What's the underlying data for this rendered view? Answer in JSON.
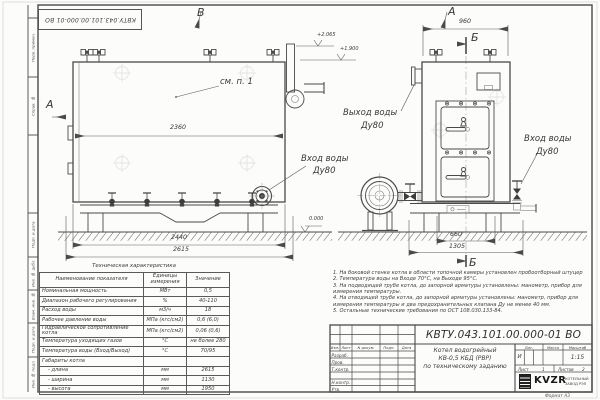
{
  "stamp": "КВТУ.043.101.00.000-01 ВО",
  "margin_labels": [
    "Перв. примен.",
    "Справ. №",
    "Подп. и дата",
    "Инв. № дубл.",
    "Взам. инв. №",
    "Подп. и дата",
    "Инв. № подл."
  ],
  "labels": {
    "view_b": "В",
    "section_a": "А",
    "view_a": "А",
    "section_b": "Б",
    "see_note": "см. п. 1",
    "outlet1": "Выход воды",
    "outlet2": "Ду80",
    "inlet1": "Вход воды",
    "inlet2": "Ду80"
  },
  "dims": {
    "body_len": "2360",
    "base_len": "2440",
    "total_len": "2615",
    "front_w": "960",
    "base_w": "660",
    "total_w": "1305",
    "lvl_zero": "0.000",
    "lvl_top": "+2.065",
    "lvl_mid": "+1.900"
  },
  "notes": [
    "1. На боковой стенке котла в области топочной камеры установлен пробоотборный штуцер",
    "2. Температура воды на Входе 70°С, на Выходе 95°С.",
    "3. На подводящей трубе котла, до запорной арматуры установлены: манометр, прибор для измерения температуры.",
    "4. На отводящей трубе котла, до запорной арматуры установлены: манометр, прибор для измерения температуры и два предохранительных клапана Ду не менее 40 мм.",
    "5. Остальные технические требования по ОСТ 108.030.133-84."
  ],
  "table": {
    "title": "Техническая характеристика",
    "headers": [
      "Наименование показателя",
      "Единицы измерения",
      "Значение"
    ],
    "rows": [
      {
        "name": "Номинальная мощность",
        "unit": "МВт",
        "value": "0,5"
      },
      {
        "name": "Диапазон рабочего регулирования",
        "unit": "%",
        "value": "40-110"
      },
      {
        "name": "Расход воды",
        "unit": "м3/ч",
        "value": "18"
      },
      {
        "name": "Рабочее давление воды",
        "unit": "МПа (кгс/см2)",
        "value": "0,6 (6,0)"
      },
      {
        "name": "Гидравлическое сопротивление котла",
        "unit": "МПа (кгс/см2)",
        "value": "0,06 (0,6)"
      },
      {
        "name": "Температура уходящих газов",
        "unit": "°С",
        "value": "не более 280"
      },
      {
        "name": "Температура воды (Вход/Выход)",
        "unit": "°С",
        "value": "70/95"
      },
      {
        "name": "Габариты котла",
        "unit": "",
        "value": ""
      },
      {
        "name": "- длина",
        "unit": "мм",
        "value": "2615"
      },
      {
        "name": "- ширина",
        "unit": "мм",
        "value": "1130"
      },
      {
        "name": "- высота",
        "unit": "мм",
        "value": "1950"
      }
    ]
  },
  "titleblock": {
    "doc_number": "КВТУ.043.101.00.000-01 ВО",
    "title_lines": [
      "Котел водогрейный",
      "КВ-0,5 КБД (РВР)",
      "по техническому заданию"
    ],
    "cols": [
      "Изм.",
      "Лист",
      "N докум.",
      "Подп.",
      "Дата"
    ],
    "sign_rows": [
      "Разраб.",
      "Пров.",
      "Т.контр.",
      "Н.контр.",
      "Утв."
    ],
    "lit_label": "Лит.",
    "mass_label": "Масса",
    "scale_label": "Масштаб",
    "lit": "И",
    "scale": "1:15",
    "sheet_label": "Лист",
    "sheet_no": "1",
    "sheets_label": "Листов",
    "sheets_no": "2",
    "brand": "KVZR",
    "brand_line1": "КОТЕЛЬНЫЙ",
    "brand_line2": "ЗАВОД РЭП",
    "format": "Формат А3"
  }
}
